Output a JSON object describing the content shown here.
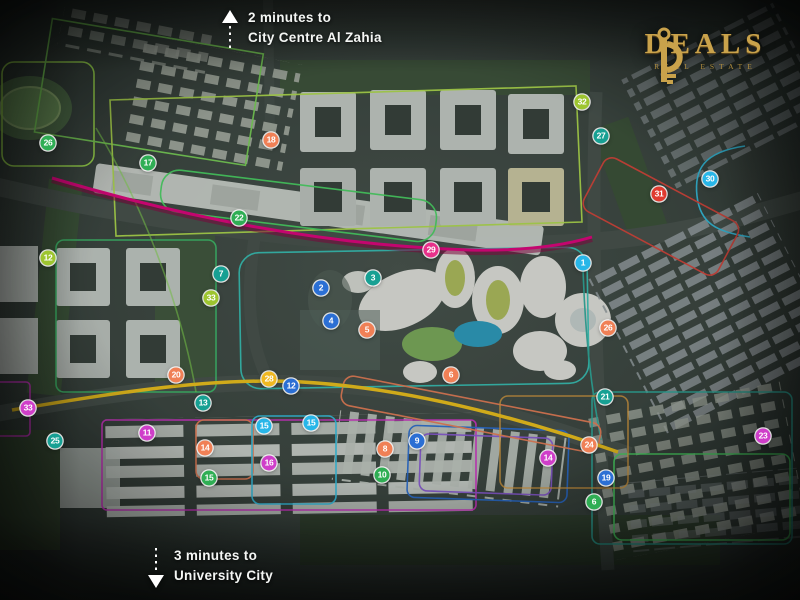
{
  "annotations": {
    "top": {
      "line1": "2 minutes to",
      "line2": "City Centre Al Zahia"
    },
    "bottom": {
      "line1": "3 minutes to",
      "line2": "University City"
    }
  },
  "logo": {
    "title": "DEALS",
    "tagline": "REAL ESTATE",
    "gold": "#c9a24b"
  },
  "map": {
    "palette": {
      "green": "#2fae54",
      "lime": "#9dc52f",
      "teal": "#17a093",
      "cyan": "#28b6e8",
      "blue": "#2b6fd4",
      "salmon": "#f08056",
      "yellow": "#f0b821",
      "pink": "#e8308a",
      "magenta": "#cf3ec9",
      "red": "#e03a2f"
    },
    "roads": {
      "primary": "#e6007e",
      "secondary": "#f5c518"
    },
    "markers": [
      {
        "label": "26",
        "x": 48,
        "y": 143,
        "color": "green"
      },
      {
        "label": "17",
        "x": 148,
        "y": 163,
        "color": "green"
      },
      {
        "label": "18",
        "x": 271,
        "y": 140,
        "color": "salmon"
      },
      {
        "label": "22",
        "x": 239,
        "y": 218,
        "color": "green"
      },
      {
        "label": "12",
        "x": 48,
        "y": 258,
        "color": "lime"
      },
      {
        "label": "7",
        "x": 221,
        "y": 274,
        "color": "teal"
      },
      {
        "label": "33",
        "x": 211,
        "y": 298,
        "color": "lime"
      },
      {
        "label": "2",
        "x": 321,
        "y": 288,
        "color": "blue"
      },
      {
        "label": "3",
        "x": 373,
        "y": 278,
        "color": "teal"
      },
      {
        "label": "4",
        "x": 331,
        "y": 321,
        "color": "blue"
      },
      {
        "label": "5",
        "x": 367,
        "y": 330,
        "color": "salmon"
      },
      {
        "label": "29",
        "x": 431,
        "y": 250,
        "color": "pink"
      },
      {
        "label": "6",
        "x": 451,
        "y": 375,
        "color": "salmon"
      },
      {
        "label": "1",
        "x": 583,
        "y": 263,
        "color": "cyan"
      },
      {
        "label": "32",
        "x": 582,
        "y": 102,
        "color": "lime"
      },
      {
        "label": "27",
        "x": 601,
        "y": 136,
        "color": "teal"
      },
      {
        "label": "30",
        "x": 710,
        "y": 179,
        "color": "cyan"
      },
      {
        "label": "31",
        "x": 659,
        "y": 194,
        "color": "red"
      },
      {
        "label": "26",
        "x": 608,
        "y": 328,
        "color": "salmon"
      },
      {
        "label": "21",
        "x": 605,
        "y": 397,
        "color": "teal"
      },
      {
        "label": "28",
        "x": 269,
        "y": 379,
        "color": "yellow"
      },
      {
        "label": "12",
        "x": 291,
        "y": 386,
        "color": "blue"
      },
      {
        "label": "20",
        "x": 176,
        "y": 375,
        "color": "salmon"
      },
      {
        "label": "13",
        "x": 203,
        "y": 403,
        "color": "teal"
      },
      {
        "label": "11",
        "x": 147,
        "y": 433,
        "color": "magenta"
      },
      {
        "label": "25",
        "x": 55,
        "y": 441,
        "color": "teal"
      },
      {
        "label": "33",
        "x": 28,
        "y": 408,
        "color": "magenta"
      },
      {
        "label": "14",
        "x": 205,
        "y": 448,
        "color": "salmon"
      },
      {
        "label": "15",
        "x": 264,
        "y": 426,
        "color": "cyan"
      },
      {
        "label": "15",
        "x": 311,
        "y": 423,
        "color": "cyan"
      },
      {
        "label": "16",
        "x": 269,
        "y": 463,
        "color": "magenta"
      },
      {
        "label": "15",
        "x": 209,
        "y": 478,
        "color": "green"
      },
      {
        "label": "9",
        "x": 417,
        "y": 441,
        "color": "blue"
      },
      {
        "label": "8",
        "x": 385,
        "y": 449,
        "color": "salmon"
      },
      {
        "label": "10",
        "x": 382,
        "y": 475,
        "color": "green"
      },
      {
        "label": "14",
        "x": 548,
        "y": 458,
        "color": "magenta"
      },
      {
        "label": "24",
        "x": 589,
        "y": 445,
        "color": "salmon"
      },
      {
        "label": "23",
        "x": 763,
        "y": 436,
        "color": "magenta"
      },
      {
        "label": "19",
        "x": 606,
        "y": 478,
        "color": "blue"
      },
      {
        "label": "6",
        "x": 594,
        "y": 502,
        "color": "green"
      }
    ]
  }
}
